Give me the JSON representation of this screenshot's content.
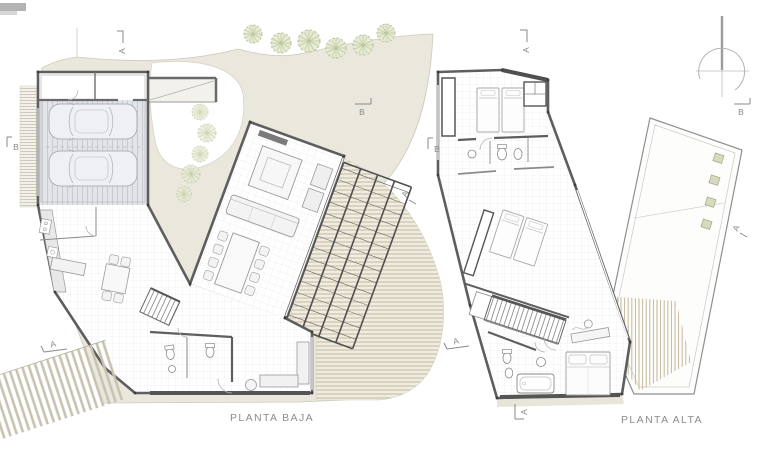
{
  "plans": [
    {
      "name": "planta-baja",
      "title": "PLANTA BAJA",
      "markers": [
        {
          "letter": "A",
          "position": "top"
        },
        {
          "letter": "A",
          "position": "bottom-left"
        },
        {
          "letter": "B",
          "position": "left"
        },
        {
          "letter": "B",
          "position": "right"
        },
        {
          "letter": "A",
          "position": "right-mid"
        }
      ]
    },
    {
      "name": "planta-alta",
      "title": "PLANTA ALTA",
      "markers": [
        {
          "letter": "A",
          "position": "top"
        },
        {
          "letter": "A",
          "position": "bottom"
        },
        {
          "letter": "A",
          "position": "left-mid"
        },
        {
          "letter": "B",
          "position": "left"
        },
        {
          "letter": "B",
          "position": "right"
        },
        {
          "letter": "A",
          "position": "right-mid"
        }
      ]
    }
  ],
  "colors": {
    "site_fill": "#eae7dd",
    "site_edge": "#cdc9bb",
    "deck_line": "#c4b89b",
    "wall": "#5e5e5e",
    "thin": "#8a8a8a",
    "label": "#8c8c8c",
    "tree": "#b7c394",
    "tree_fill": "#e7ebd6",
    "skylight": "#d8dabe",
    "garage_floor": "#e2e4e8",
    "pergola": "#4f4f4f"
  }
}
